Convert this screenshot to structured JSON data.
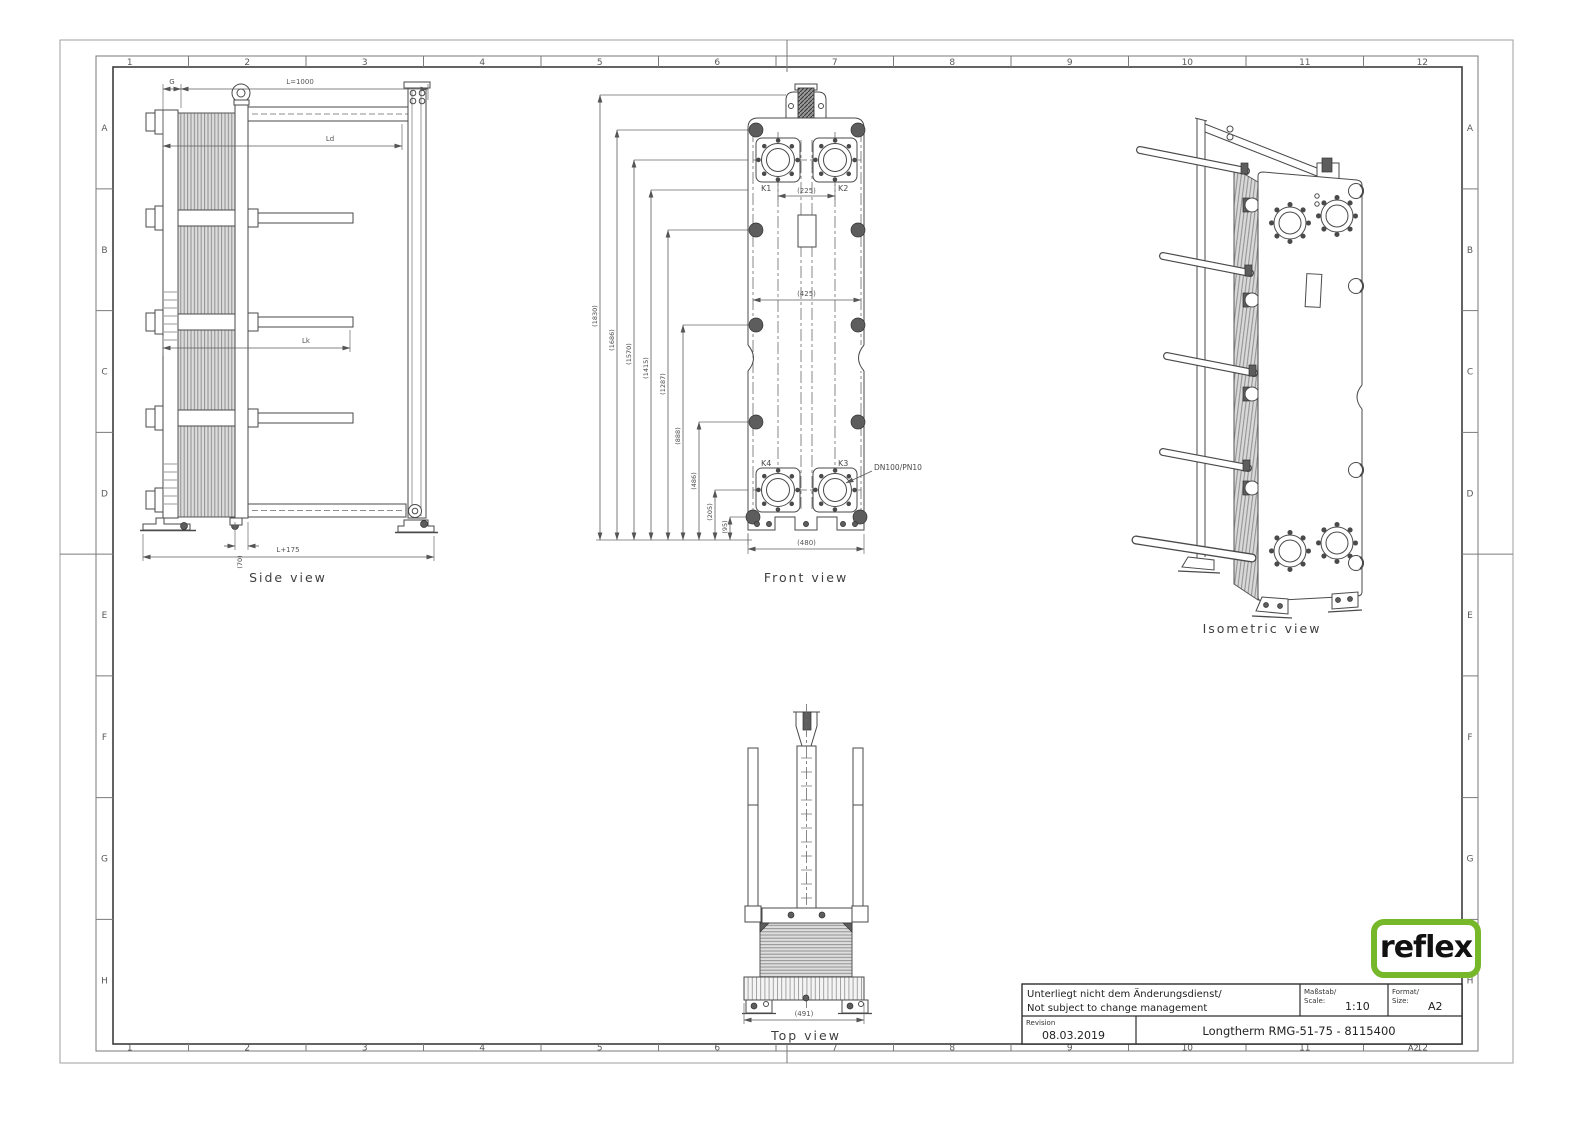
{
  "sheet": {
    "corner_code": "A2",
    "grid_columns": [
      "1",
      "2",
      "3",
      "4",
      "5",
      "6",
      "7",
      "8",
      "9",
      "10",
      "11",
      "12"
    ],
    "grid_rows": [
      "A",
      "B",
      "C",
      "D",
      "E",
      "F",
      "G",
      "H"
    ]
  },
  "views": {
    "side": {
      "label": "Side view",
      "dim_g": "G",
      "dim_length": "L=1000",
      "dim_ld": "Ld",
      "dim_lk": "Lk",
      "dim_foot": "(70)",
      "dim_overall": "L+175"
    },
    "front": {
      "label": "Front view",
      "height_dims": [
        "(1830)",
        "(1686)",
        "(1570)",
        "(1415)",
        "(1287)",
        "(888)",
        "(486)",
        "(205)",
        "(95)"
      ],
      "port_k1": "K1",
      "port_k2": "K2",
      "port_k3": "K3",
      "port_k4": "K4",
      "dim_port_spacing": "(225)",
      "dim_bolt_width": "(425)",
      "dim_width": "(480)",
      "connection_spec": "DN100/PN10"
    },
    "top": {
      "label": "Top view",
      "dim_width": "(491)"
    },
    "isometric": {
      "label": "Isometric view"
    }
  },
  "title_block": {
    "change_note_de": "Unterliegt nicht dem Änderungsdienst/",
    "change_note_en": "Not subject to change management",
    "scale_label_de": "Maßstab/",
    "scale_label_en": "Scale:",
    "scale_value": "1:10",
    "format_label_de": "Format/",
    "format_label_en": "Size:",
    "format_value": "A2",
    "revision_label": "Revision",
    "revision_date": "08.03.2019",
    "drawing_title": "Longtherm RMG-51-75 - 8115400"
  },
  "logo": {
    "text": "reflex",
    "green": "#76b82a"
  }
}
